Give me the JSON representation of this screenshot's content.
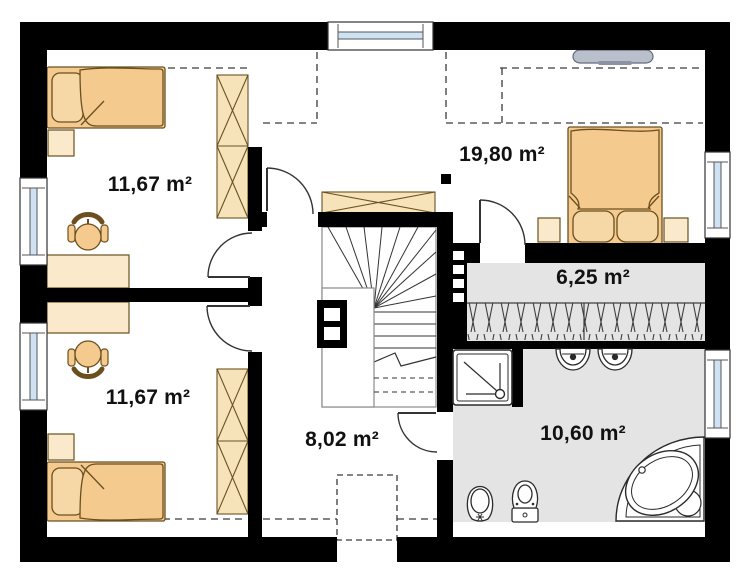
{
  "plan": {
    "type": "attic-floor-plan",
    "rooms": [
      {
        "id": "room-top-left",
        "area_label": "11,67 m²"
      },
      {
        "id": "room-bottom-left",
        "area_label": "11,67 m²"
      },
      {
        "id": "bedroom",
        "area_label": "19,80 m²"
      },
      {
        "id": "wardrobe-room",
        "area_label": "6,25 m²"
      },
      {
        "id": "hall",
        "area_label": "8,02 m²"
      },
      {
        "id": "bathroom",
        "area_label": "10,60 m²"
      }
    ],
    "colors": {
      "wall": "#000000",
      "floor": "#ffffff",
      "wet_room_floor": "#e4e4e4",
      "furniture": "#f4ca8e",
      "furniture_light": "#fbe9cb",
      "wardrobe_fill": "#f7e3ba",
      "outline": "#6b4f1e",
      "glazing": "#cfe2f3",
      "fixture_outline": "#2b2b2b",
      "tv": "#b9c0cc",
      "label_text": "#111111"
    },
    "icons": [
      "single-bed-icon",
      "double-bed-icon",
      "pillow-icon",
      "nightstand-icon",
      "desk-icon",
      "chair-icon",
      "wardrobe-icon",
      "stairs-icon",
      "chimney-icon",
      "flue-block-icon",
      "tv-icon",
      "window-icon",
      "door-arc-icon",
      "shower-icon",
      "washbasin-icon",
      "toilet-icon",
      "bidet-icon",
      "corner-bathtub-icon",
      "clothes-rail-hatch",
      "skylight-dashed-outline",
      "column-marker"
    ]
  }
}
